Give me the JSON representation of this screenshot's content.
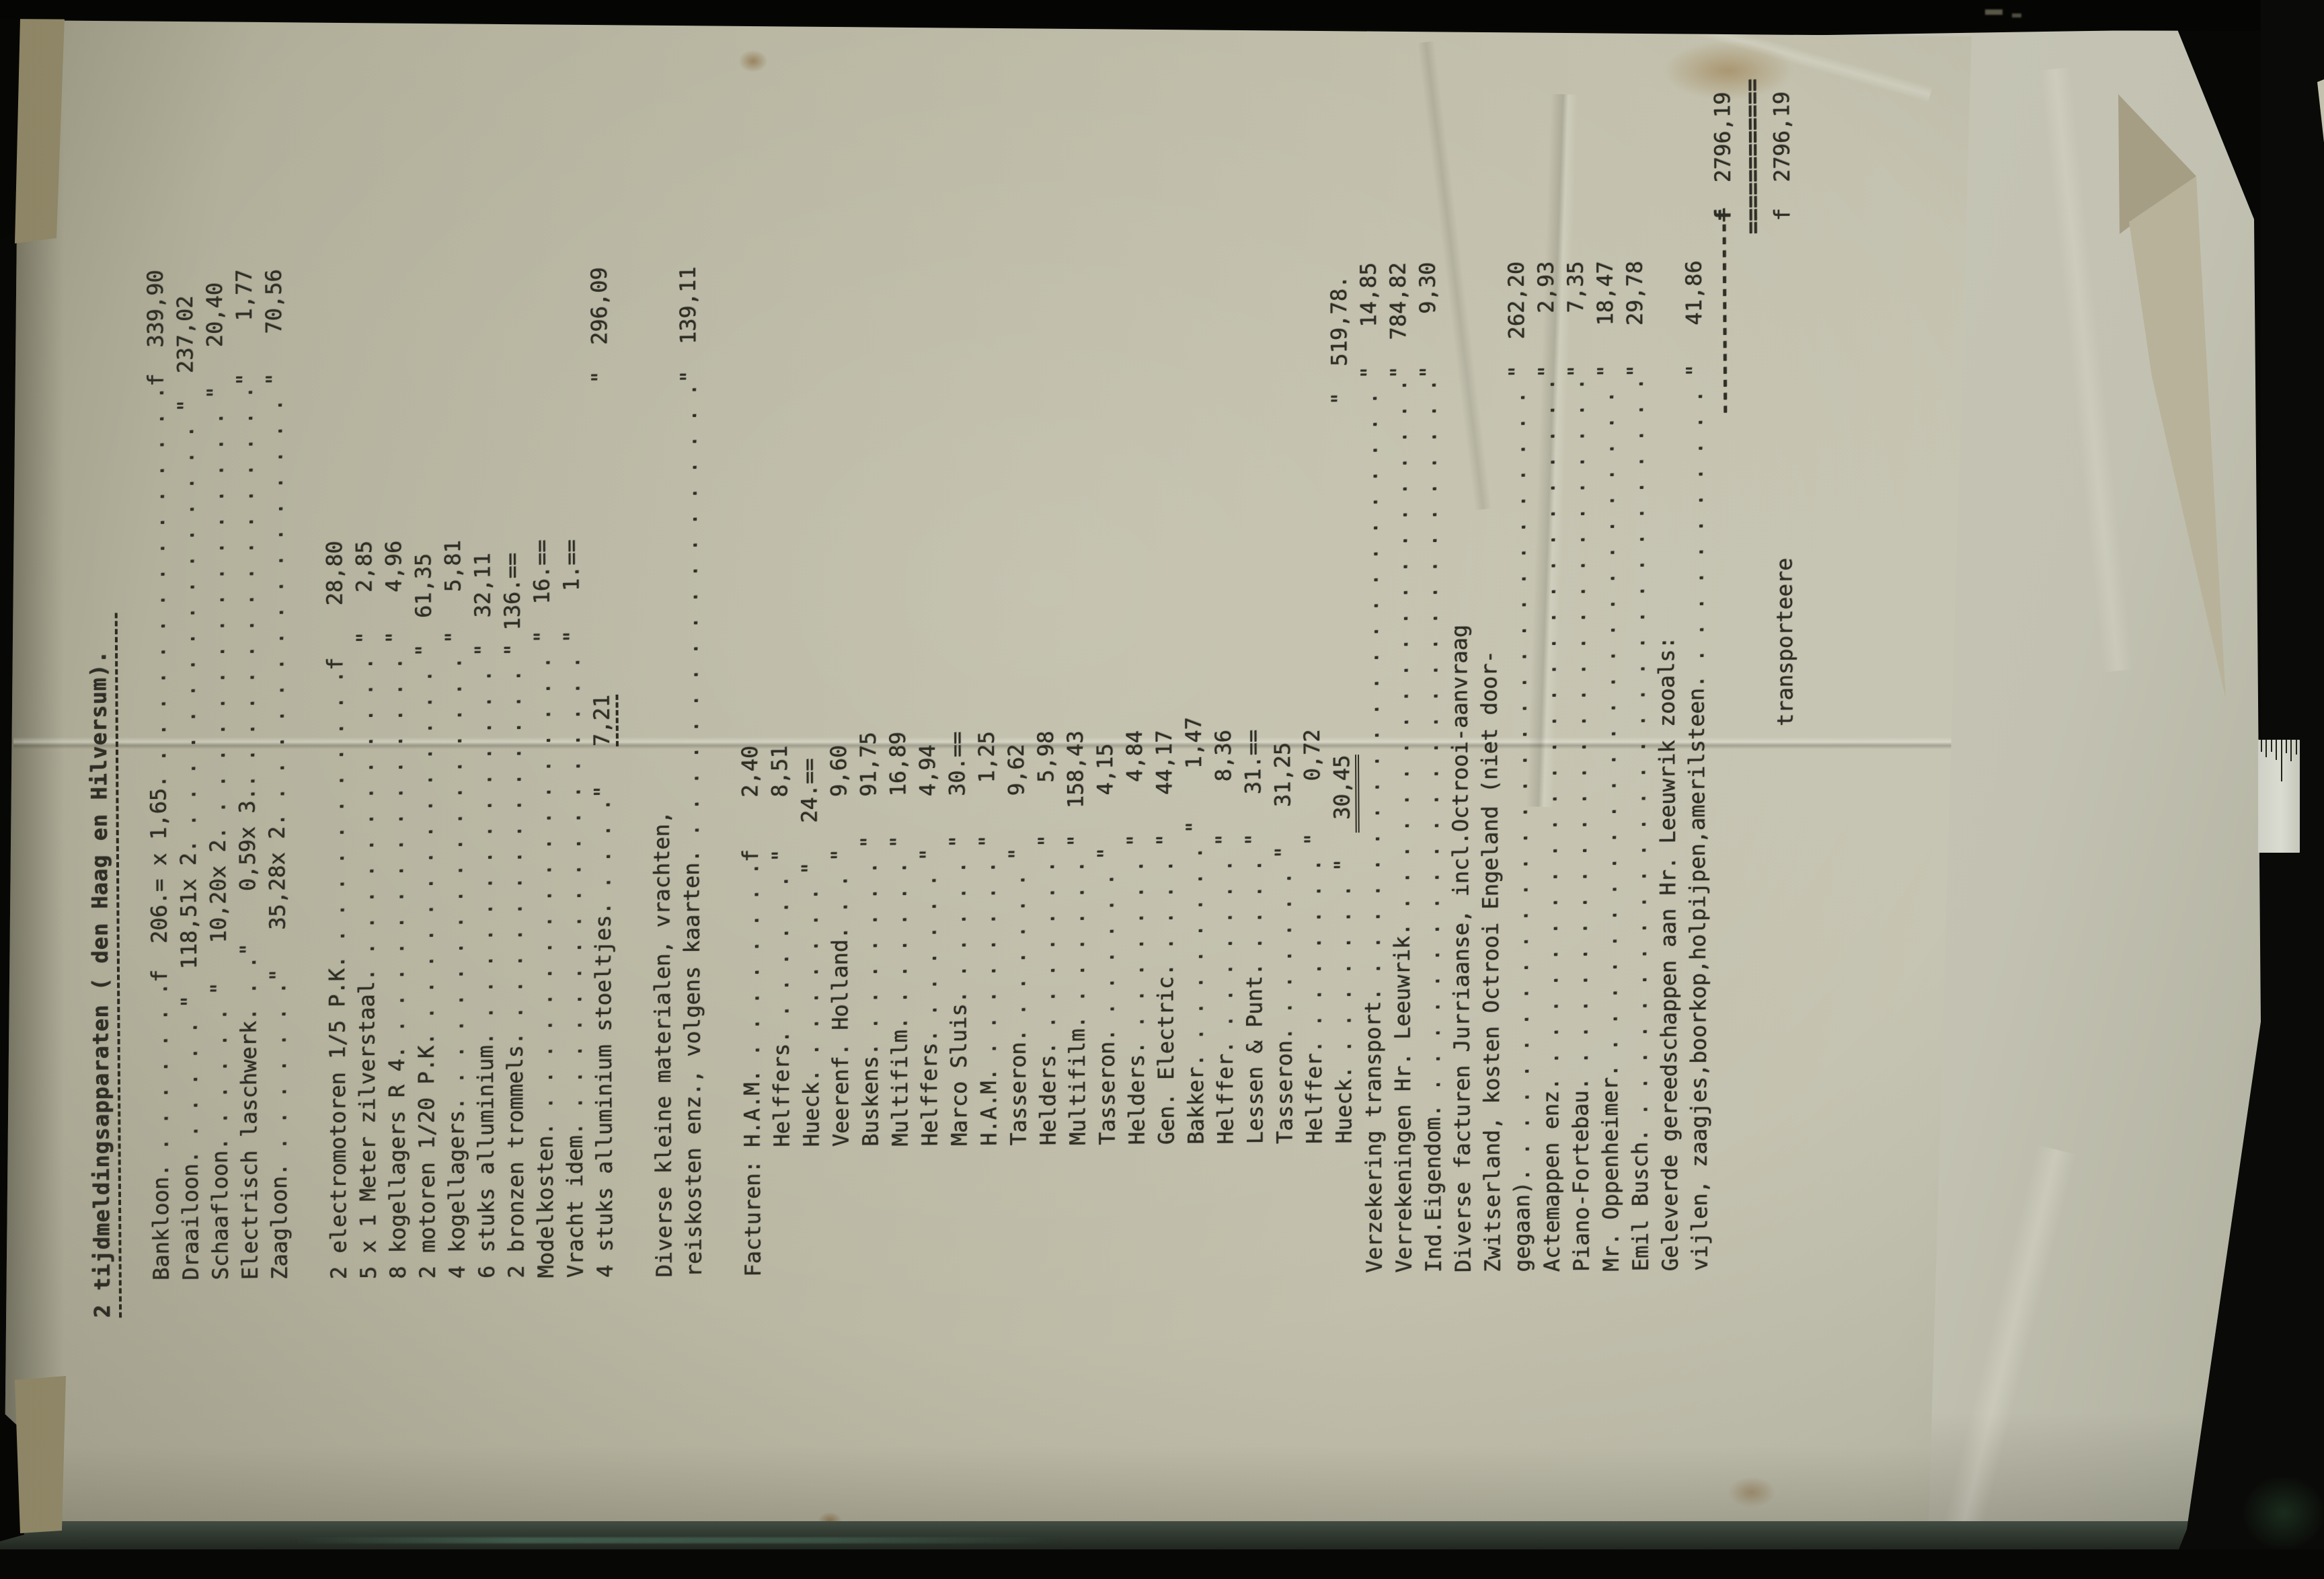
{
  "colors": {
    "background": "#070706",
    "paper_typed": "#bcbaa6",
    "paper_back": "#c3c2b0",
    "ink": "#2f2e26",
    "table": "#333c33",
    "ruler": "#dadbd1"
  },
  "document": {
    "lines": [
      {
        "n": "title-line",
        "cls": "title",
        "parts": [
          {
            "t": "2 tijdmeldingsapparaten ( den Haag en Hilversum).",
            "cls": "u-title"
          }
        ]
      },
      {
        "t": ""
      },
      {
        "n": "line-bankloon",
        "t": "Bankloon. . . . . . . .f  206.= x 1,65. . . . . . . . . . . . . . . .f  339,90"
      },
      {
        "n": "line-draailoon",
        "t": "Draailoon. . . . . . \"  118,51x 2. . . . . . . . . . . . . . . . . \"  237,02"
      },
      {
        "n": "line-schaafloon",
        "t": "Schaafloon. . . . . . \"   10,20x 2. . . . . . . . . . . . . . . . . \"   20,40"
      },
      {
        "n": "line-electrisch",
        "t": "Electrisch laschwerk. . .\"    0,59x 3.. . . . . . . . . . . . . . . .\"    1,77"
      },
      {
        "n": "line-zaagloon",
        "t": "Zaagloon. . . . . . . .\"   35,28x 2. . . . . . . . . . . . . . . . . \"   70,56"
      },
      {
        "t": ""
      },
      {
        "n": "line-electromotoren",
        "t": "2 electromotoren 1/5 P.K. . . . . . . . . . . .f    28,80"
      },
      {
        "n": "line-zilverstaal",
        "t": "5 x 1 Meter zilverstaal. . . . . . . . . . . . . \"   2,85"
      },
      {
        "n": "line-kogellagers-r4",
        "t": "8 kogellagers R 4. . . . . . . . . . . . . . . . \"   4,96"
      },
      {
        "n": "line-motoren",
        "t": "2 motoren 1/20 P.K. . . . . . . . . . . . . . . \"  61,35"
      },
      {
        "n": "line-kogellagers",
        "t": "4 kogellagers. . . . . . . . . . . . . . . . . . \"   5,81"
      },
      {
        "n": "line-alluminium",
        "t": "6 stuks alluminium. . . . . . . . . . . . . . . \"  32,11"
      },
      {
        "n": "line-trommels",
        "t": "2 bronzen trommels. . . . . . . . . . . . . . . \" 136.=="
      },
      {
        "n": "line-modelkosten",
        "t": "Modelkosten. . . . . . . . . . . . . . . . . . . \"  16.=="
      },
      {
        "n": "line-vracht",
        "t": "Vracht idem. . . . . . . . . . . . . . . . . . . \"   1.=="
      },
      {
        "n": "line-stoeltjes",
        "parts": [
          {
            "t": "4 stuks alluminium stoeltjes. . . . .\"   "
          },
          {
            "t": "7,21",
            "cls": "u-dash"
          },
          {
            "t": "                        \"  296,09"
          }
        ]
      },
      {
        "t": ""
      },
      {
        "n": "line-diverse-1",
        "t": "Diverse kleine materialen, vrachten,"
      },
      {
        "n": "line-diverse-2",
        "t": "reiskosten enz., volgens kaarten. . . . . . . . . . . . . . . . . . .\"  139,11"
      },
      {
        "t": ""
      },
      {
        "n": "line-facturen-ham",
        "t": "Facturen: H.A.M. . . . . . . . .f    2,40"
      },
      {
        "n": "line-facturen-helffers1",
        "t": "          Helffers. . . . . . . \"    8,51"
      },
      {
        "n": "line-facturen-hueck1",
        "t": "          Hueck. . . . . . . . \"   24.=="
      },
      {
        "n": "line-facturen-veerenf",
        "t": "          Veerenf. Holland. . . \"    9,60"
      },
      {
        "n": "line-facturen-buskens",
        "t": "          Buskens. . . . . . . . \"   91,75"
      },
      {
        "n": "line-facturen-multifilm1",
        "t": "          Multifilm. . . . . . . \"   16,89"
      },
      {
        "n": "line-facturen-helffers2",
        "t": "          Helffers. . . . . . . \"    4,94"
      },
      {
        "n": "line-facturen-marcosluis",
        "t": "          Marco Sluis. . . . . . \"   30.=="
      },
      {
        "n": "line-facturen-ham2",
        "t": "          H.A.M. . . . . . . . . \"    1,25"
      },
      {
        "n": "line-facturen-tasseron1",
        "t": "          Tasseron. . . . . . . \"    9,62"
      },
      {
        "n": "line-facturen-helders1",
        "t": "          Helders. . . . . . . . \"    5,98"
      },
      {
        "n": "line-facturen-multifilm2",
        "t": "          Multifilm. . . . . . . \"  158,43"
      },
      {
        "n": "line-facturen-tasseron2",
        "t": "          Tasseron. . . . . . . \"    4,15"
      },
      {
        "n": "line-facturen-helders2",
        "t": "          Helders. . . . . . . . \"    4,84"
      },
      {
        "n": "line-facturen-genelectric",
        "t": "          Gen. Electric. . . . . \"   44,17"
      },
      {
        "n": "line-facturen-bakker",
        "t": "          Bakker. . . . . . . . . \"    1,47"
      },
      {
        "n": "line-facturen-helffer1",
        "t": "          Helffer. . . . . . . . \"    8,36"
      },
      {
        "n": "line-facturen-lessenpunt",
        "t": "          Lessen & Punt. . . . . \"   31.=="
      },
      {
        "n": "line-facturen-tasseron3",
        "t": "          Tasseron. . . . . . . \"   31,25"
      },
      {
        "n": "line-facturen-helffer2",
        "t": "          Helffer. . . . . . . . \"    0,72"
      },
      {
        "n": "line-facturen-hueck2",
        "parts": [
          {
            "t": "          Hueck. . . . . . . . \"  "
          },
          {
            "t": " 30,45",
            "cls": "u-dbl"
          },
          {
            "t": "                           \"  519,78."
          }
        ]
      },
      {
        "n": "line-verzekering",
        "t": "Verzekering transport. . . . . . . . . . . . . . . . . . . . . . . . \"   14,85"
      },
      {
        "n": "line-verrekeningen",
        "t": "Verrekeningen Hr. Leeuwrik. . . . . . . . . . . . . . . . . . . . . .\"  784,82"
      },
      {
        "n": "line-ind-eigendom",
        "t": "Ind.Eigendom. . . . . . . . . . . . . . . . . . . . . . . . . . . . .\"    9,30"
      },
      {
        "n": "line-jurriaanse",
        "t": "Diverse facturen Jurriaanse, incl.Octrooi-aanvraag"
      },
      {
        "n": "line-zwitserland",
        "t": "Zwitserland, kosten Octrooi Engeland (niet door-"
      },
      {
        "n": "line-gegaan",
        "t": "gegaan). . . . . . . . . . . . . . . . . . . . . . . . . . . . . . . \"  262,20"
      },
      {
        "n": "line-actemappen",
        "t": "Actemappen enz. . . . . . . . . . . . . . . . . . . . . . . . . . . .\"    2,93"
      },
      {
        "n": "line-piano",
        "t": "Piano-Fortebau. . . . . . . . . . . . . . . . . . . . . . . . . . . .\"    7,35"
      },
      {
        "n": "line-oppenheimer",
        "t": "Mr. Oppenheimer. . . . . . . . . . . . . . . . . . . . . . . . . . . \"   18,47"
      },
      {
        "n": "line-emil-busch",
        "t": "Emil Busch. . . . . . . . . . . . . . . . . . . . . . . . . . . . . .\"   29,78"
      },
      {
        "n": "line-geleverde",
        "t": "Geleverde gereedschappen aan Hr. Leeuwrik zooals:"
      },
      {
        "n": "line-vijlen",
        "t": "vijlen, zaagjes,boorkop,holpijpen,amerilsteen. . . . . . . . . . . . \"   41,86"
      },
      {
        "n": "line-total",
        "parts": [
          {
            "t": "                                                                  "
          },
          {
            "t": "---------------",
            "cls": "bold"
          },
          {
            "t": "f",
            "cls": "strike"
          },
          {
            "t": "  2796,19"
          }
        ]
      },
      {
        "n": "line-total-rule",
        "parts": [
          {
            "t": "                                                                                "
          },
          {
            "t": "============",
            "cls": "bold"
          }
        ]
      },
      {
        "n": "line-transporteere",
        "t": "                                          transporteere                          f  2796,19"
      }
    ]
  },
  "ruler": {
    "tick_heights": [
      18,
      26,
      18,
      30,
      62,
      20,
      32,
      22
    ]
  }
}
